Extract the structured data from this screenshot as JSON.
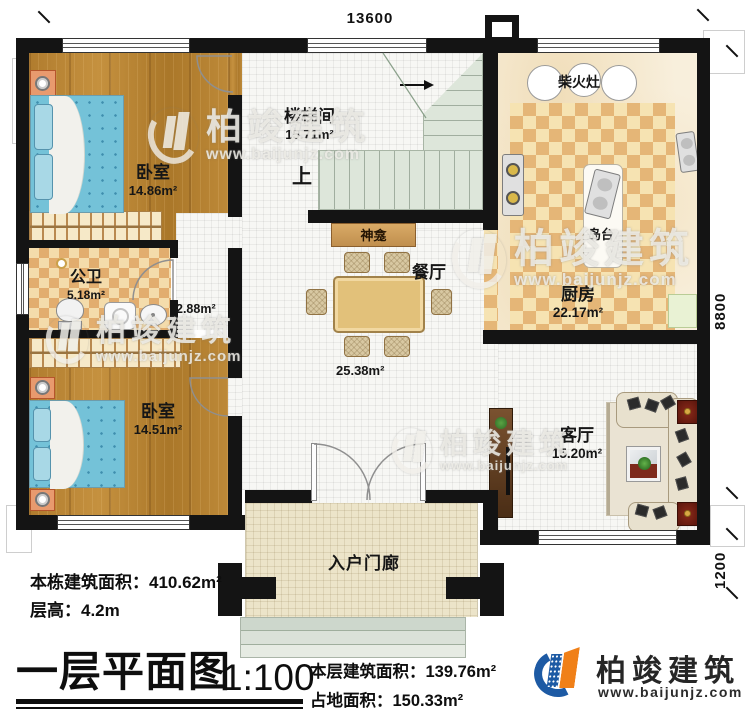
{
  "dimensions": {
    "top": "13600",
    "right": "8800",
    "porch_right": "1200"
  },
  "rooms": {
    "bedroom1": {
      "name": "卧室",
      "area": "14.86m²"
    },
    "stairwell": {
      "name": "楼梯间",
      "area": "15.71m²",
      "up": "上"
    },
    "bathroom": {
      "name": "公卫",
      "area": "5.18m²"
    },
    "hallway": {
      "area": "2.88m²"
    },
    "shrine": {
      "name": "神龛"
    },
    "dining": {
      "name": "餐厅",
      "area": "25.38m²"
    },
    "kitchen": {
      "name": "厨房",
      "area": "22.17m²",
      "stove": "柴火灶",
      "island": "岛台"
    },
    "bedroom2": {
      "name": "卧室",
      "area": "14.51m²"
    },
    "living": {
      "name": "客厅",
      "area": "15.20m²"
    },
    "porch": {
      "name": "入户门廊"
    }
  },
  "notes": {
    "building_area_label": "本栋建筑面积：",
    "building_area_value": "410.62m²",
    "floor_height_label": "层高：",
    "floor_height_value": "4.2m"
  },
  "titleblock": {
    "title": "一层平面图",
    "scale": "1:100",
    "floor_area_label": "本层建筑面积：",
    "floor_area_value": "139.76m²",
    "footprint_label": "占地面积：",
    "footprint_value": "150.33m²"
  },
  "brand": {
    "name": "柏竣建筑",
    "url": "www.baijunjz.com",
    "icon": "building-swoosh-logo"
  },
  "watermark": {
    "name": "柏竣建筑",
    "url": "www.baijunjz.com"
  },
  "colors": {
    "wall": "#141414",
    "wood_floor": "#b5812f",
    "checker_tan": "#e5b677",
    "stair_green": "#dde6da",
    "brand_blue": "#1d5aa4",
    "brand_orange": "#f08018"
  }
}
